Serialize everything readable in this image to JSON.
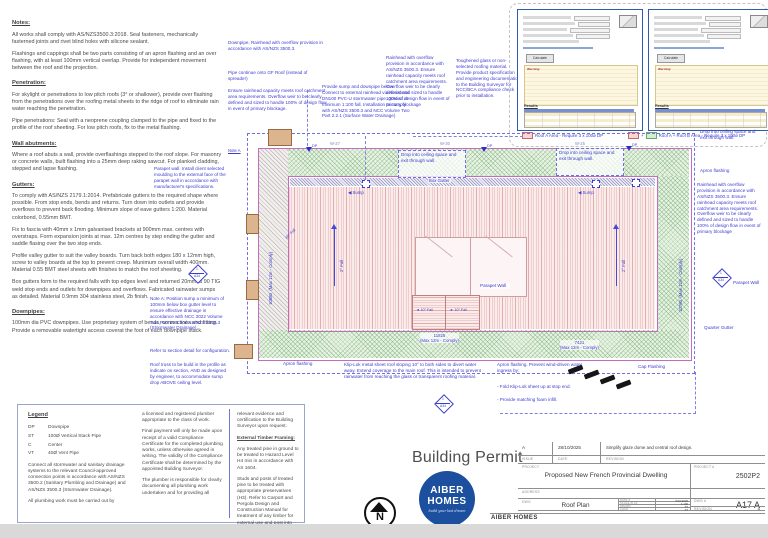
{
  "notes": {
    "sections": [
      {
        "heading": "Notes:",
        "paras": [
          "All works shall comply with AS/NZS3500.3:2018. Seal fasteners, mechanically fasterned joints and rivet blind holes with silicone sealant.",
          "Flashings and cappings shall be two parts consisting of an apron flashing and an over flashing, with at least 100mm vertical overlap. Provide for independent movement between the roof and the projection."
        ]
      },
      {
        "heading": "Penetration:",
        "paras": [
          "For skylight or penetrations to low pitch roofs (3° or shallower), provide over flashing from the penetrations over the roofing metal sheets to the ridge of roof to eliminate rain water reaching the penetration.",
          "Pipe penetrations: Seal with a neoprene coupling clamped to the pipe and fixed to the profile of the roof sheeting.  For low pitch roofs, fix to the metal flashing."
        ]
      },
      {
        "heading": "Wall abutments:",
        "paras": [
          "Where a roof abuts a wall, provide overflashings stepped to the roof slope.  For masonry or concrete walls, built flashing into a 25mm deep raking sawcut.  For planked cladding, stepped and lapse flashing."
        ]
      },
      {
        "heading": "Gutters:",
        "paras": [
          "To comply with AS/NZS 2179.1:2014.  Prefabricate gutters to the required shape where possible.  From stop ends, bends and returns.  Turn down into outlets and provide overflows to prevent back flooding. Minimum slope of eave gutters 1:200. Material colorbond, 0.55mm BMT.",
          "Fix to fascia with 40mm x 1mm galvanised brackets at 900mm max. centres with overstraps.  Form expansion joints at max. 12m centres by step ending the gutter and saddle flasing over the two stop ends.",
          "Profile valley gutter to suit the valley boards.  Turn back both edges 180 x 12mm high, screw to valley boards at the top to prevent creep.  Munimum overall width 400mm. Material 0.55 BMT steel sheets with finishes to match the roof sheeting.",
          "Box gutters form to the required falls with top edges level and returned 20mm at 90 TIG weld stop ends and outlets for downpipes and overflows. Fabricated rainwater sumps as detailed.  Material 0.9mm 304 stainless steel, 2b finish."
        ]
      },
      {
        "heading": "Downpipes:",
        "paras": [
          "100mm dia PVC downpipes.  Use proprietary system of bends, connections and fitting.  Provide a removable watertight access coverat the foot of each downpipe stack."
        ]
      }
    ]
  },
  "legend": {
    "title": "Legend",
    "items": [
      {
        "abbr": "DP",
        "desc": "Downpipe"
      },
      {
        "abbr": "ST",
        "desc": "100Ø Vertical Stack Pipe"
      },
      {
        "abbr": "C",
        "desc": "Center"
      },
      {
        "abbr": "VT",
        "desc": "40Ø Vent Pipe"
      }
    ],
    "para1": "Connect all stormwater and sanitary drainage systems to the relevant Council-approved connection points in accordance with AS/NZS 3500.2 (Sanitary Plumbing and Drainage) and AS/NZS 3500.3 (Stormwater Drainage).",
    "para2": "All plumbing work must be carried out by",
    "col2": [
      "a licensed and registered plumber appropriate to the class of work.",
      "Final payment will only be made upon receipt of a valid Compliance Certificate for the completed plumbing works, unless otherwise agreed in writing. The validity of the Compliance Certificate shall be determined by the appointed Building Surveyor.",
      "The plumber is responsible for clearly documenting all plumbing work undertaken and for providing all"
    ],
    "col3_p1": "relevant evidence and certification to the Building Surveyor upon request.",
    "col3_heading": "External Timber Framing:",
    "col3_p2": "Any treated pine in ground to be treated to Hazard Level H4 min in accordance with AS 1604.",
    "col3_p3": "Studs and posts of treated pine to be treated with appropriate preservatives (H3).  Refer to Carport and Pergola Design and Construction Manual for treatment of any timber for external use and post into footing embedment."
  },
  "annotations": {
    "downpipe_rainhead": "Downpipe, Rainhead with overflow provision in accordance with AS/NZS 3500.3.",
    "pipe_continue": "Pipe continue onto GF Roof (instead of spreader)",
    "ensure_rainhead": "Ensure rainhead capacity meets roof catchment area requirements. Overflow weir to be clearly defined and sized to handle 100% of design flow in event of primary blockage.",
    "provide_sump": "Provide sump and downpipe below. Connect to external rainhead via horizontal DN100 PVC-U stormwater pipe, graded at minimum 1:100 fall. Installation to comply with AS/NZS 3500.3 and NCC Volume Two Part 2.2.1 (Surface Water Drainage)",
    "rainhead_top": "Rainhead with overflow provision in accordance with AS/NZS 3500.3. Ensure rainhead capacity meets roof catchment area requirements. Overflow weir to be clearly defined and sized to handle 100% of design flow in event of primary blockage",
    "toughened_glass": "Toughened glass or non-selected roofing material. Provide product specification and engineering documentation to the Building Surveyor for NCC/BCA compliance check prior to installation.",
    "parapet_install": "Parapet wall. Install client selected moulding to the external face of the parapet wall in accordance with manufacturer's specifications.",
    "note_a_label": "Note A",
    "note_a": "Note A: Position sump a minimum of 100mm below box gutter level to ensure effective drainage in accordance with NCC 2022 Volume Two Part 10.5 and AS/NZS 3500.3 (Stormwater Drainage).",
    "refer_section": "Refer to section detail for configuration.",
    "roof_truss": "Roof truss to be build in the profile as indicate on section, AND as designed by engineer, to accommodate sump drop ABOVE ceiling level.",
    "drop_ceiling": "Drop into ceiling space and exit through wall.",
    "klip_lok": "Klip-Lok metal sheet roof sloping 10° to both sides to divert water away. Extend coverage to the main roof. This is intended to prevent rainwater from reaching the glass or transparent roofing material.",
    "apron_prevent": "Apron flashing. Prevent wind-driven water ingress by:",
    "fold1": "- Fold Klip-Lok sheet up at stop end.",
    "fold2": "- Provide matching foam infill."
  },
  "plan": {
    "labels": {
      "box_gutter": "Box Gutter",
      "sump": "Sump",
      "dp": "DP",
      "fall2": "2° Fall",
      "fall45": "45° Fall",
      "fall10": "10° Fall",
      "parapet_wall": "Parapet Wall",
      "apron_flashing": "Apron flashing",
      "cap_flashing": "Cap Flashing",
      "quarter_gutter": "Quarter Gutter"
    },
    "dims": {
      "left": "10880",
      "right": "10760",
      "bottom1": "11825",
      "bottom2": "7421",
      "max": "(Max 12m - Comply)"
    },
    "tags": [
      "W-27",
      "W-30",
      "W-25"
    ],
    "section_marker": {
      "num": "1",
      "sheet": "A34"
    }
  },
  "insets": {
    "left_caption": "Roof A Area - Require 3 x 100ø DP",
    "right_caption": "Roof A + Roof B Area - Require 3 x 100ø DP",
    "plus": "+",
    "calculate_label": "Calculate",
    "warning_label": "Warning:",
    "results_label": "Results"
  },
  "titleblock": {
    "building_permit": "Building Permit",
    "logo_line1": "AIBER",
    "logo_line2": "HOMES",
    "logo_tagline": "build your last dream",
    "issue_value": "A",
    "issue_date": "28/10/2025",
    "issue_desc": "Simplify glaze dome and central roof design.",
    "issue_label": "ISSUE",
    "date_label": "DATE",
    "revision_label": "REVISION",
    "project_label": "PROJECT",
    "project": "Proposed New French Provincial Dwelling",
    "project_no_label": "PROJECT #",
    "project_no": "2502P2",
    "address_label": "ADDRESS",
    "dwg_label": "DWG",
    "dwg": "Roof Plan",
    "date2_label": "DATE #",
    "date2": "6/10/2025",
    "scale_label": "SCALE @ A1",
    "scale": "1:100",
    "drawn_label": "DRAWN",
    "drawn": "TT",
    "chkd_label": "CHKD",
    "chkd": "TT",
    "dwgno_label": "DWG #",
    "dwgno": "A17 A",
    "rev2_label": "REVISION",
    "rev2": "A",
    "company": "AIBER HOMES",
    "phone": "T 0421 888 088",
    "email": "E  benardwimby@outlook.com",
    "north": "N"
  }
}
